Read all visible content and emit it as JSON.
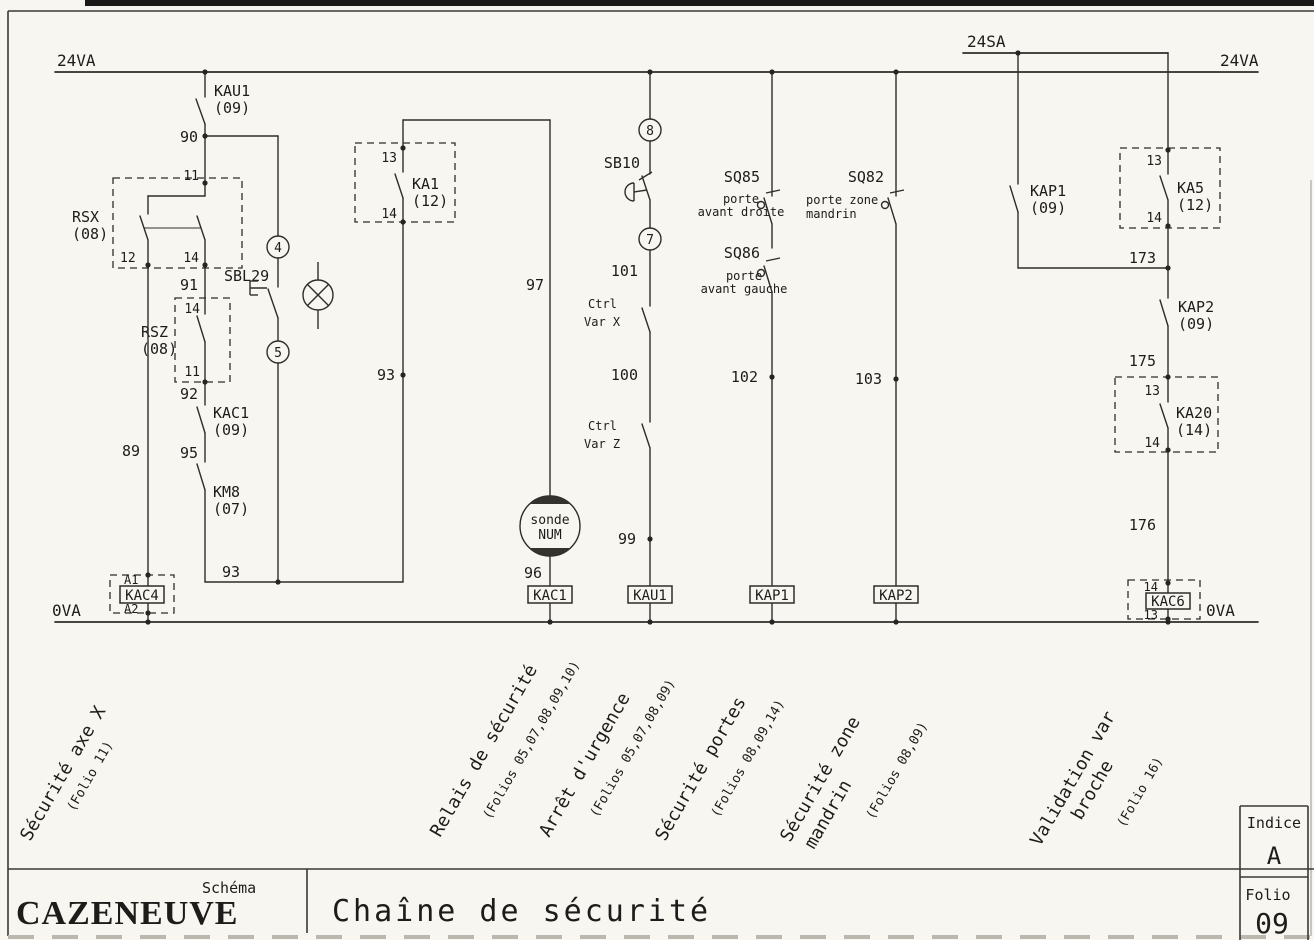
{
  "colors": {
    "paper": "#f7f6f1",
    "ink": "#2e2d2b"
  },
  "rails": {
    "top_left": "24VA",
    "top_right": "24VA",
    "aux": "24SA",
    "bottom_left": "0VA",
    "bottom_right": "0VA"
  },
  "left": {
    "kau1": {
      "name": "KAU1",
      "folio": "(09)"
    },
    "n90": "90",
    "n91": "91",
    "n92": "92",
    "n95": "95",
    "n89": "89",
    "n93": "93",
    "rsx": {
      "name": "RSX",
      "folio": "(08)",
      "t11": "11",
      "t12": "12",
      "t14": "14"
    },
    "rsz": {
      "name": "RSZ",
      "folio": "(08)",
      "t14": "14",
      "t11": "11"
    },
    "kac1": {
      "name": "KAC1",
      "folio": "(09)"
    },
    "km8": {
      "name": "KM8",
      "folio": "(07)"
    },
    "sbl29": {
      "name": "SBL29",
      "c4": "4",
      "c5": "5"
    },
    "kac4": {
      "name": "KAC4",
      "a1": "A1",
      "a2": "A2"
    }
  },
  "ka1branch": {
    "ka1": {
      "name": "KA1",
      "folio": "(12)",
      "t13": "13",
      "t14": "14"
    },
    "n93": "93",
    "n97": "97",
    "n96": "96",
    "sonde_line1": "sonde",
    "sonde_line2": "NUM",
    "coil": "KAC1"
  },
  "mid": {
    "c8": "8",
    "sb10": "SB10",
    "c7": "7",
    "n101": "101",
    "n100": "100",
    "n99": "99",
    "ctrlx1": "Ctrl",
    "ctrlx2": "Var X",
    "ctrlz1": "Ctrl",
    "ctrlz2": "Var Z",
    "coil": "KAU1"
  },
  "doors": {
    "sq85": "SQ85",
    "sq85d1": "porte",
    "sq85d2": "avant droite",
    "sq86": "SQ86",
    "sq86d1": "porte",
    "sq86d2": "avant gauche",
    "n102": "102",
    "coil": "KAP1"
  },
  "mandrin": {
    "sq82": "SQ82",
    "d1": "porte zone",
    "d2": "mandrin",
    "n103": "103",
    "coil": "KAP2"
  },
  "right": {
    "kap1": {
      "name": "KAP1",
      "folio": "(09)"
    },
    "ka5": {
      "name": "KA5",
      "folio": "(12)",
      "t13": "13",
      "t14": "14"
    },
    "n173": "173",
    "n175": "175",
    "n176": "176",
    "kap2": {
      "name": "KAP2",
      "folio": "(09)"
    },
    "ka20": {
      "name": "KA20",
      "folio": "(14)",
      "t13": "13",
      "t14": "14"
    },
    "kac6": {
      "name": "KAC6",
      "t14": "14",
      "t13": "13"
    }
  },
  "sections": [
    {
      "line1": "Sécurité axe X",
      "line2": "",
      "folios": "(Folio 11)"
    },
    {
      "line1": "Relais de sécurité",
      "line2": "",
      "folios": "(Folios 05,07,08,09,10)"
    },
    {
      "line1": "Arrêt d'urgence",
      "line2": "",
      "folios": "(Folios 05,07,08,09)"
    },
    {
      "line1": "Sécurité portes",
      "line2": "",
      "folios": "(Folios 08,09,14)"
    },
    {
      "line1": "Sécurité zone",
      "line2": "mandrin",
      "folios": "(Folios 08,09)"
    },
    {
      "line1": "Validation var",
      "line2": "broche",
      "folios": "(Folio 16)"
    }
  ],
  "title_block": {
    "brand": "CAZENEUVE",
    "doc_type": "Schéma",
    "title": "Chaîne de sécurité",
    "indice_label": "Indice",
    "indice": "A",
    "folio_label": "Folio",
    "folio": "09"
  }
}
